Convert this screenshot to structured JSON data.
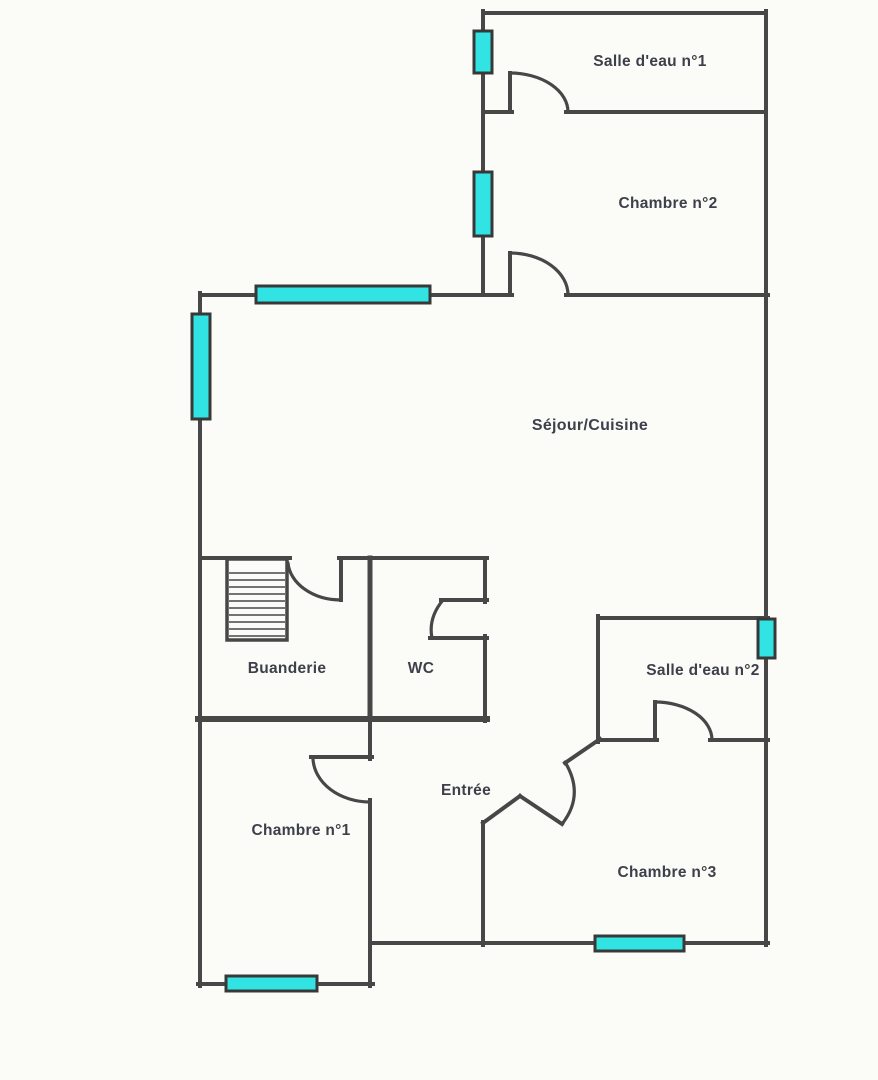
{
  "plan": {
    "width": 878,
    "height": 1080,
    "colors": {
      "background": "#fbfbf7",
      "wall": "#474747",
      "window_fill": "#31e3e3",
      "window_border": "#383838",
      "label": "#3d3f4a"
    },
    "rooms": [
      {
        "slug": "salle-deau-1",
        "label": "Salle d'eau n°1",
        "cx": 650,
        "cy": 66,
        "font": 15.5
      },
      {
        "slug": "chambre-2",
        "label": "Chambre n°2",
        "cx": 668,
        "cy": 208,
        "font": 15.5
      },
      {
        "slug": "sejour-cuisine",
        "label": "Séjour/Cuisine",
        "cx": 590,
        "cy": 430,
        "font": 16
      },
      {
        "slug": "buanderie",
        "label": "Buanderie",
        "cx": 287,
        "cy": 673,
        "font": 15.5
      },
      {
        "slug": "wc",
        "label": "WC",
        "cx": 421,
        "cy": 673,
        "font": 15.5
      },
      {
        "slug": "salle-deau-2",
        "label": "Salle d'eau n°2",
        "cx": 703,
        "cy": 675,
        "font": 15.5
      },
      {
        "slug": "chambre-1",
        "label": "Chambre n°1",
        "cx": 301,
        "cy": 835,
        "font": 15.5
      },
      {
        "slug": "entree",
        "label": "Entrée",
        "cx": 466,
        "cy": 795,
        "font": 15.5
      },
      {
        "slug": "chambre-3",
        "label": "Chambre n°3",
        "cx": 667,
        "cy": 877,
        "font": 15.5
      }
    ],
    "walls": [
      {
        "x1": 483,
        "y1": 13,
        "x2": 766,
        "y2": 13,
        "w": 4
      },
      {
        "x1": 483,
        "y1": 112,
        "x2": 512,
        "y2": 112,
        "w": 4
      },
      {
        "x1": 566,
        "y1": 112,
        "x2": 766,
        "y2": 112,
        "w": 4
      },
      {
        "x1": 200,
        "y1": 295,
        "x2": 512,
        "y2": 295,
        "w": 4
      },
      {
        "x1": 566,
        "y1": 295,
        "x2": 768,
        "y2": 295,
        "w": 4
      },
      {
        "x1": 200,
        "y1": 558,
        "x2": 290,
        "y2": 558,
        "w": 4
      },
      {
        "x1": 339,
        "y1": 558,
        "x2": 487,
        "y2": 558,
        "w": 4
      },
      {
        "x1": 598,
        "y1": 618,
        "x2": 768,
        "y2": 618,
        "w": 4
      },
      {
        "x1": 198,
        "y1": 719,
        "x2": 487,
        "y2": 719,
        "w": 6
      },
      {
        "x1": 598,
        "y1": 740,
        "x2": 657,
        "y2": 740,
        "w": 4
      },
      {
        "x1": 710,
        "y1": 740,
        "x2": 768,
        "y2": 740,
        "w": 4
      },
      {
        "x1": 311,
        "y1": 757,
        "x2": 372,
        "y2": 757,
        "w": 4
      },
      {
        "x1": 441,
        "y1": 600,
        "x2": 487,
        "y2": 600,
        "w": 4
      },
      {
        "x1": 430,
        "y1": 638,
        "x2": 487,
        "y2": 638,
        "w": 4
      },
      {
        "x1": 371,
        "y1": 943,
        "x2": 768,
        "y2": 943,
        "w": 4
      },
      {
        "x1": 198,
        "y1": 984,
        "x2": 373,
        "y2": 984,
        "w": 4
      },
      {
        "x1": 483,
        "y1": 11,
        "x2": 483,
        "y2": 295,
        "w": 4
      },
      {
        "x1": 766,
        "y1": 11,
        "x2": 766,
        "y2": 945,
        "w": 4
      },
      {
        "x1": 200,
        "y1": 293,
        "x2": 200,
        "y2": 986,
        "w": 4
      },
      {
        "x1": 510,
        "y1": 73,
        "x2": 510,
        "y2": 112,
        "w": 4
      },
      {
        "x1": 510,
        "y1": 253,
        "x2": 510,
        "y2": 295,
        "w": 4
      },
      {
        "x1": 341,
        "y1": 558,
        "x2": 341,
        "y2": 600,
        "w": 4
      },
      {
        "x1": 370,
        "y1": 558,
        "x2": 370,
        "y2": 717,
        "w": 5
      },
      {
        "x1": 485,
        "y1": 558,
        "x2": 485,
        "y2": 602,
        "w": 4
      },
      {
        "x1": 485,
        "y1": 636,
        "x2": 485,
        "y2": 721,
        "w": 4
      },
      {
        "x1": 370,
        "y1": 717,
        "x2": 370,
        "y2": 759,
        "w": 4
      },
      {
        "x1": 370,
        "y1": 800,
        "x2": 370,
        "y2": 986,
        "w": 4
      },
      {
        "x1": 598,
        "y1": 616,
        "x2": 598,
        "y2": 742,
        "w": 4
      },
      {
        "x1": 655,
        "y1": 702,
        "x2": 655,
        "y2": 740,
        "w": 4
      },
      {
        "x1": 483,
        "y1": 822,
        "x2": 483,
        "y2": 945,
        "w": 4
      },
      {
        "x1": 483,
        "y1": 823,
        "x2": 520,
        "y2": 796,
        "w": 4
      },
      {
        "x1": 520,
        "y1": 796,
        "x2": 562,
        "y2": 824,
        "w": 4
      },
      {
        "x1": 565,
        "y1": 763,
        "x2": 600,
        "y2": 739,
        "w": 4
      }
    ],
    "door_arcs": [
      {
        "d": "M 510 73 A 58 39 0 0 1 568 112"
      },
      {
        "d": "M 510 253 A 58 42 0 0 1 568 295"
      },
      {
        "d": "M 288 563 A 53 40 0 0 0 341 600"
      },
      {
        "d": "M 443 600 Q 428 618 432 638"
      },
      {
        "d": "M 313 759 A 57 45 0 0 0 370 802"
      },
      {
        "d": "M 655 702 A 57 38 0 0 1 712 740"
      },
      {
        "d": "M 562 824 Q 585 795 565 762"
      }
    ],
    "windows": [
      {
        "x": 474,
        "y": 31,
        "w": 18,
        "h": 42
      },
      {
        "x": 474,
        "y": 172,
        "w": 18,
        "h": 64
      },
      {
        "x": 256,
        "y": 286,
        "w": 174,
        "h": 17
      },
      {
        "x": 192,
        "y": 314,
        "w": 18,
        "h": 105
      },
      {
        "x": 758,
        "y": 619,
        "w": 17,
        "h": 39
      },
      {
        "x": 595,
        "y": 936,
        "w": 89,
        "h": 15
      },
      {
        "x": 226,
        "y": 976,
        "w": 91,
        "h": 15
      }
    ],
    "staircase": {
      "x": 227,
      "y": 559,
      "w": 60,
      "h": 81,
      "hatch_start": 573,
      "hatch_step": 7,
      "hatch_count": 10
    }
  }
}
